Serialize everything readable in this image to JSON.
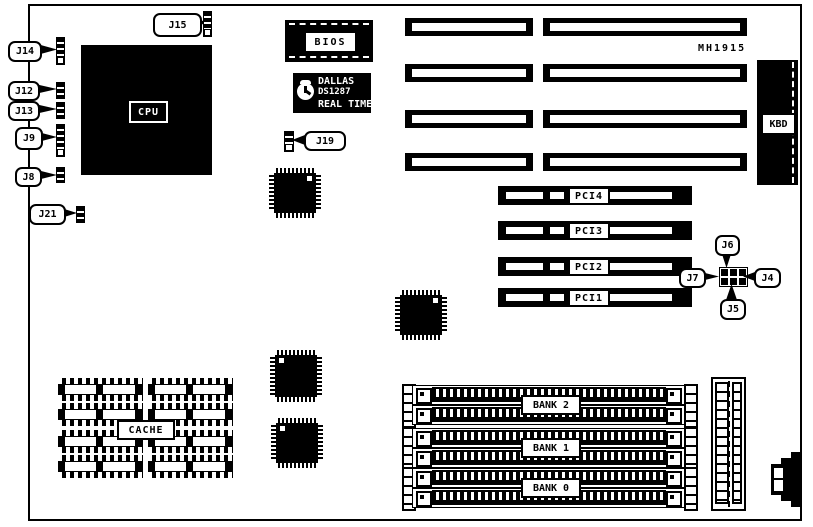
{
  "board": {
    "model_note": "MH1915",
    "colors": {
      "ink": "#000000",
      "paper": "#ffffff"
    }
  },
  "chips": {
    "cpu": "CPU",
    "bios": "BIOS",
    "cache": "CACHE",
    "kbd": "KBD",
    "rtc_line1": "DALLAS",
    "rtc_line2": "DS1287",
    "rtc_line3": "REAL TIME"
  },
  "jumpers": {
    "j14": "J14",
    "j12": "J12",
    "j13": "J13",
    "j9": "J9",
    "j8": "J8",
    "j21": "J21",
    "j15": "J15",
    "j19": "J19",
    "j6": "J6",
    "j7": "J7",
    "j4": "J4",
    "j5": "J5"
  },
  "pci_slots": [
    {
      "label": "PCI4"
    },
    {
      "label": "PCI3"
    },
    {
      "label": "PCI2"
    },
    {
      "label": "PCI1"
    }
  ],
  "memory_banks": [
    {
      "label": "BANK 2"
    },
    {
      "label": "BANK 1"
    },
    {
      "label": "BANK 0"
    }
  ]
}
